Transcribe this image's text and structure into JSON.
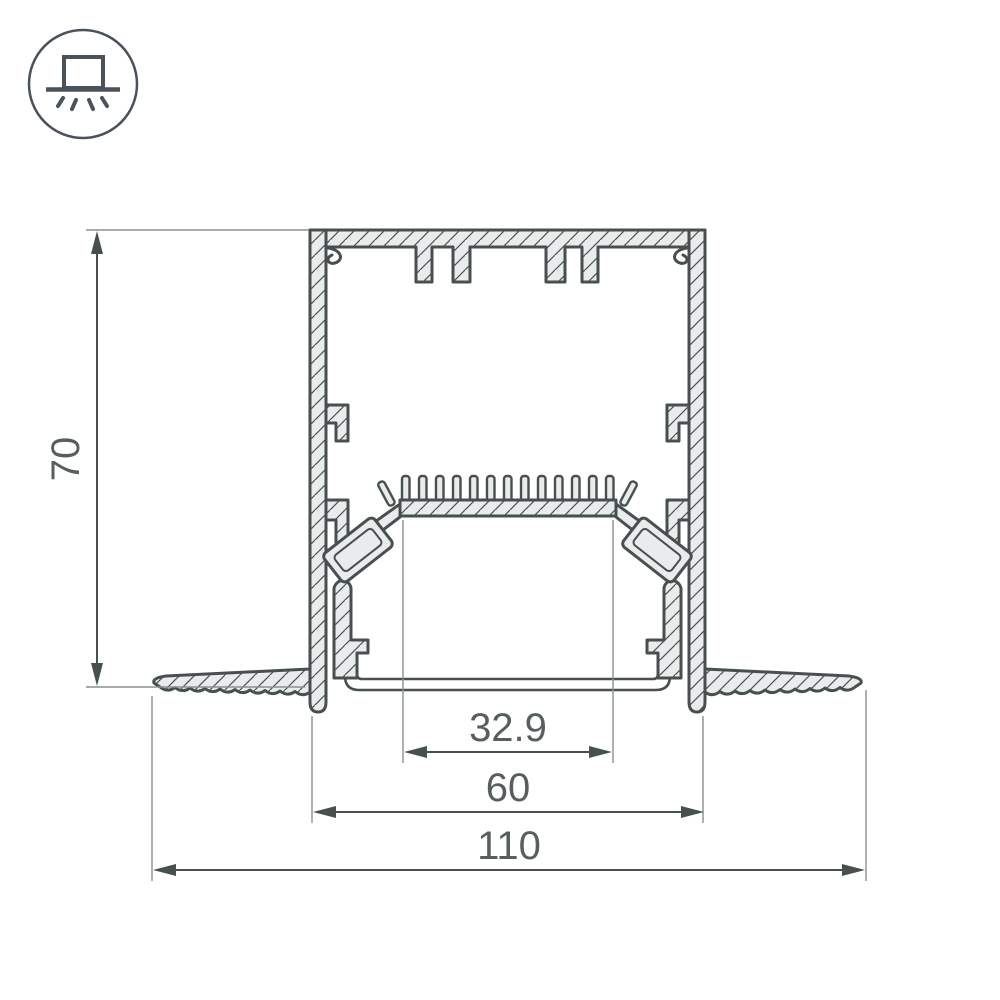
{
  "icon": {
    "name": "recessed-light-icon"
  },
  "dimensions": {
    "height": "70",
    "led_area_width": "32.9",
    "body_width": "60",
    "overall_width": "110"
  },
  "colors": {
    "line": "#47504f",
    "fill": "#e9ebec",
    "thin": "#8b9092",
    "text": "#575e60",
    "icon": "#4a525c",
    "bg": "#ffffff"
  }
}
